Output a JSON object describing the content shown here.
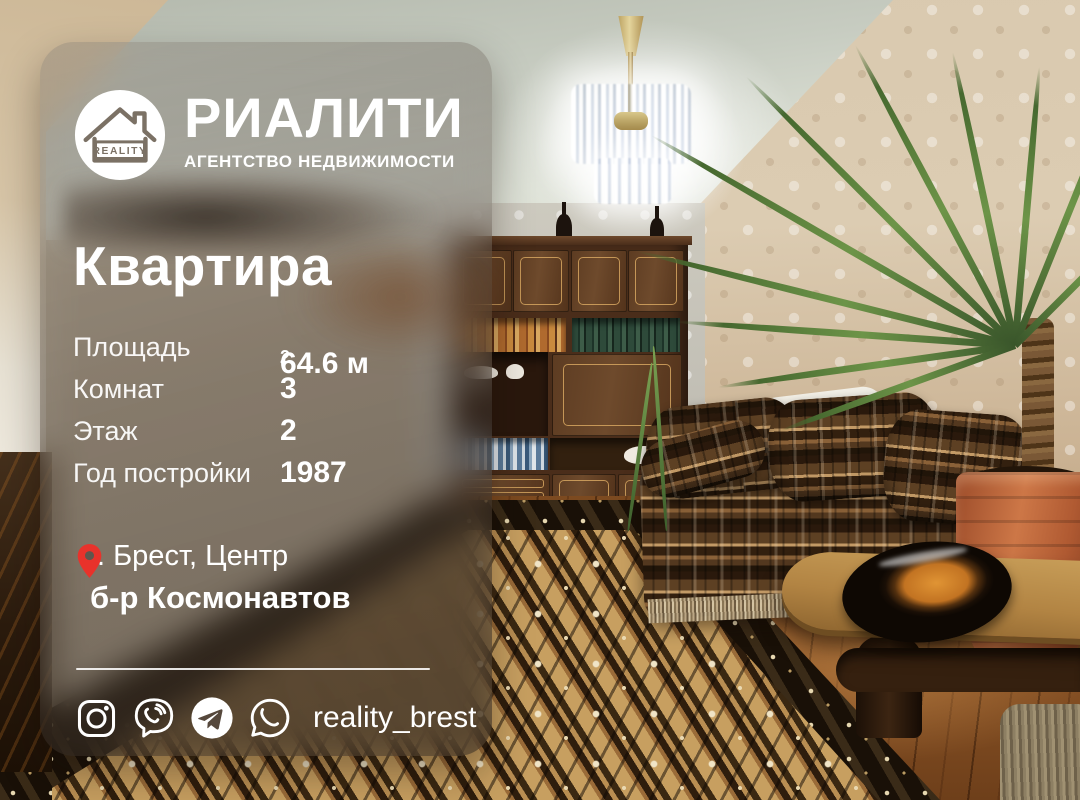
{
  "listing_card": {
    "agency": {
      "name": "РИАЛИТИ",
      "tagline": "АГЕНТСТВО НЕДВИЖИМОСТИ",
      "logo_badge": "REALITY"
    },
    "title": "Квартира",
    "properties": [
      {
        "label": "Площадь",
        "value": "64.6 м",
        "value_sup": "2"
      },
      {
        "label": "Комнат",
        "value": "3"
      },
      {
        "label": "Этаж",
        "value": "2"
      },
      {
        "label": "Год постройки",
        "value": "1987"
      }
    ],
    "location": {
      "pin_icon": "map-pin-icon",
      "line1": "г. Брест, Центр",
      "line2": "б-р Космонавтов"
    },
    "social": {
      "icons": [
        "instagram-icon",
        "viber-icon",
        "telegram-icon",
        "whatsapp-icon"
      ],
      "handle": "reality_brest"
    }
  },
  "colors": {
    "accent_red": "#e8322b",
    "text_white": "#ffffff",
    "card_tint": "rgba(64,56,48,0.44)"
  }
}
